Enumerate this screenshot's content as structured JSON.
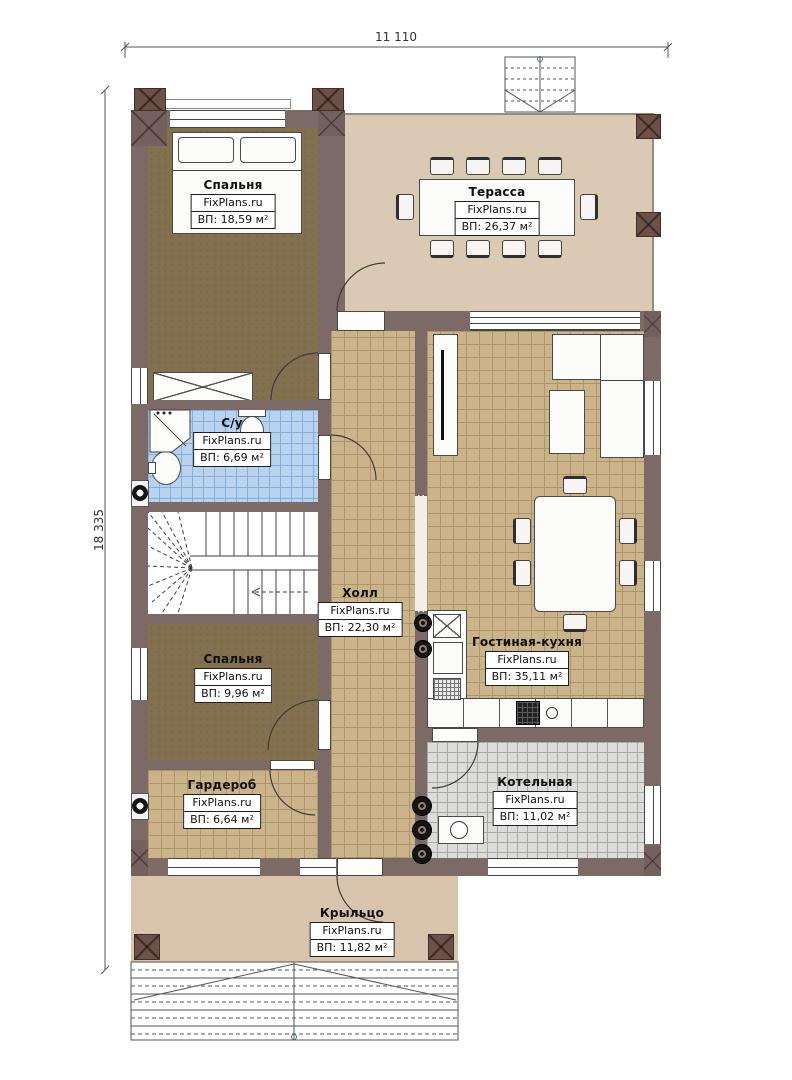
{
  "plan": {
    "dimensions": {
      "width_label": "11 110",
      "height_label": "18 335"
    },
    "rooms": [
      {
        "key": "bedroom-1",
        "name": "Спальня",
        "brand": "FixPlans.ru",
        "area": "ВП: 18,59 м²"
      },
      {
        "key": "terrace",
        "name": "Терасса",
        "brand": "FixPlans.ru",
        "area": "ВП: 26,37 м²"
      },
      {
        "key": "bathroom",
        "name": "С/у",
        "brand": "FixPlans.ru",
        "area": "ВП: 6,69 м²"
      },
      {
        "key": "hall",
        "name": "Холл",
        "brand": "FixPlans.ru",
        "area": "ВП: 22,30 м²"
      },
      {
        "key": "living-kitchen",
        "name": "Гостиная-кухня",
        "brand": "FixPlans.ru",
        "area": "ВП: 35,11 м²"
      },
      {
        "key": "bedroom-2",
        "name": "Спальня",
        "brand": "FixPlans.ru",
        "area": "ВП: 9,96 м²"
      },
      {
        "key": "wardrobe",
        "name": "Гардероб",
        "brand": "FixPlans.ru",
        "area": "ВП: 6,64 м²"
      },
      {
        "key": "boiler",
        "name": "Котельная",
        "brand": "FixPlans.ru",
        "area": "ВП: 11,02 м²"
      },
      {
        "key": "porch",
        "name": "Крыльцо",
        "brand": "FixPlans.ru",
        "area": "ВП: 11,82 м²"
      }
    ],
    "colors": {
      "wall": "#7c6a66",
      "column": "#6d5048",
      "bedroom_floor": "#82704f",
      "terrace_floor": "#dacab4",
      "tile_tan": "#cbb489",
      "tile_blue": "#b7d3ef",
      "tile_gray": "#dcdcda",
      "porch_floor": "#d8c4ad"
    }
  }
}
